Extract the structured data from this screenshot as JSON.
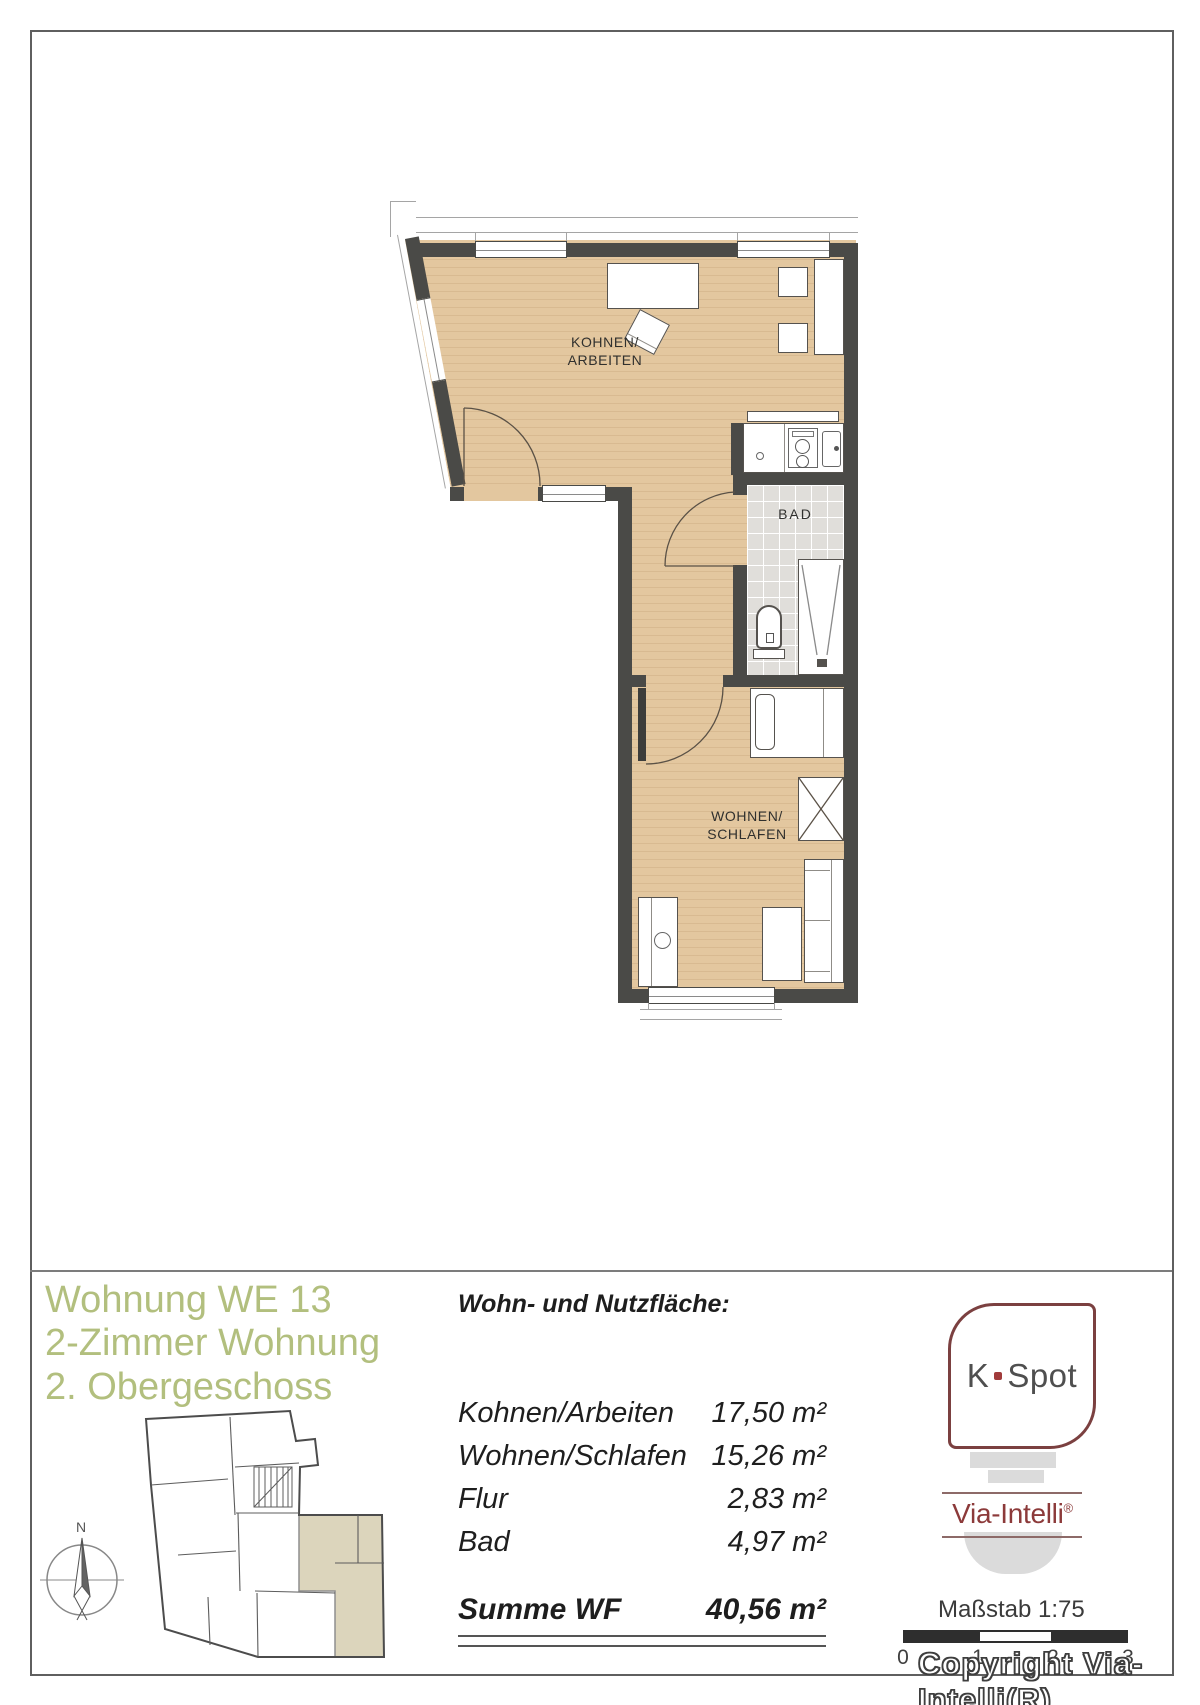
{
  "plan": {
    "living_room": {
      "line1": "KOHNEN/",
      "line2": "ARBEITEN"
    },
    "bath": {
      "label": "BAD"
    },
    "bedroom": {
      "line1": "WOHNEN/",
      "line2": "SCHLAFEN"
    }
  },
  "footer": {
    "title": {
      "line1": "Wohnung WE 13",
      "line2": "2-Zimmer Wohnung",
      "line3": "2. Obergeschoss"
    },
    "compass": {
      "north": "N"
    },
    "area_table": {
      "heading": "Wohn- und Nutzfläche:",
      "rows": [
        {
          "label": "Kohnen/Arbeiten",
          "value": "17,50 m²"
        },
        {
          "label": "Wohnen/Schlafen",
          "value": "15,26 m²"
        },
        {
          "label": "Flur",
          "value": "2,83 m²"
        },
        {
          "label": "Bad",
          "value": "4,97 m²"
        }
      ],
      "total": {
        "label": "Summe WF",
        "value": "40,56 m²"
      }
    },
    "branding": {
      "kspot": {
        "prefix": "K",
        "suffix": "Spot"
      },
      "via_intelli": {
        "name": "Via-Intelli",
        "registered": "®"
      }
    },
    "scale": {
      "label": "Maßstab 1:75",
      "ticks": [
        "0",
        "1",
        "2",
        "3"
      ]
    },
    "copyright": "Copyright Via-Intelli(R)"
  },
  "colors": {
    "accent_green": "#b2bf7e",
    "brand_red": "#8c3a3a",
    "wall": "#4a4a47",
    "floor_wood": "#e3c79f",
    "tile_gray": "#e0deda",
    "apartment_highlight": "#dcd5bc"
  }
}
